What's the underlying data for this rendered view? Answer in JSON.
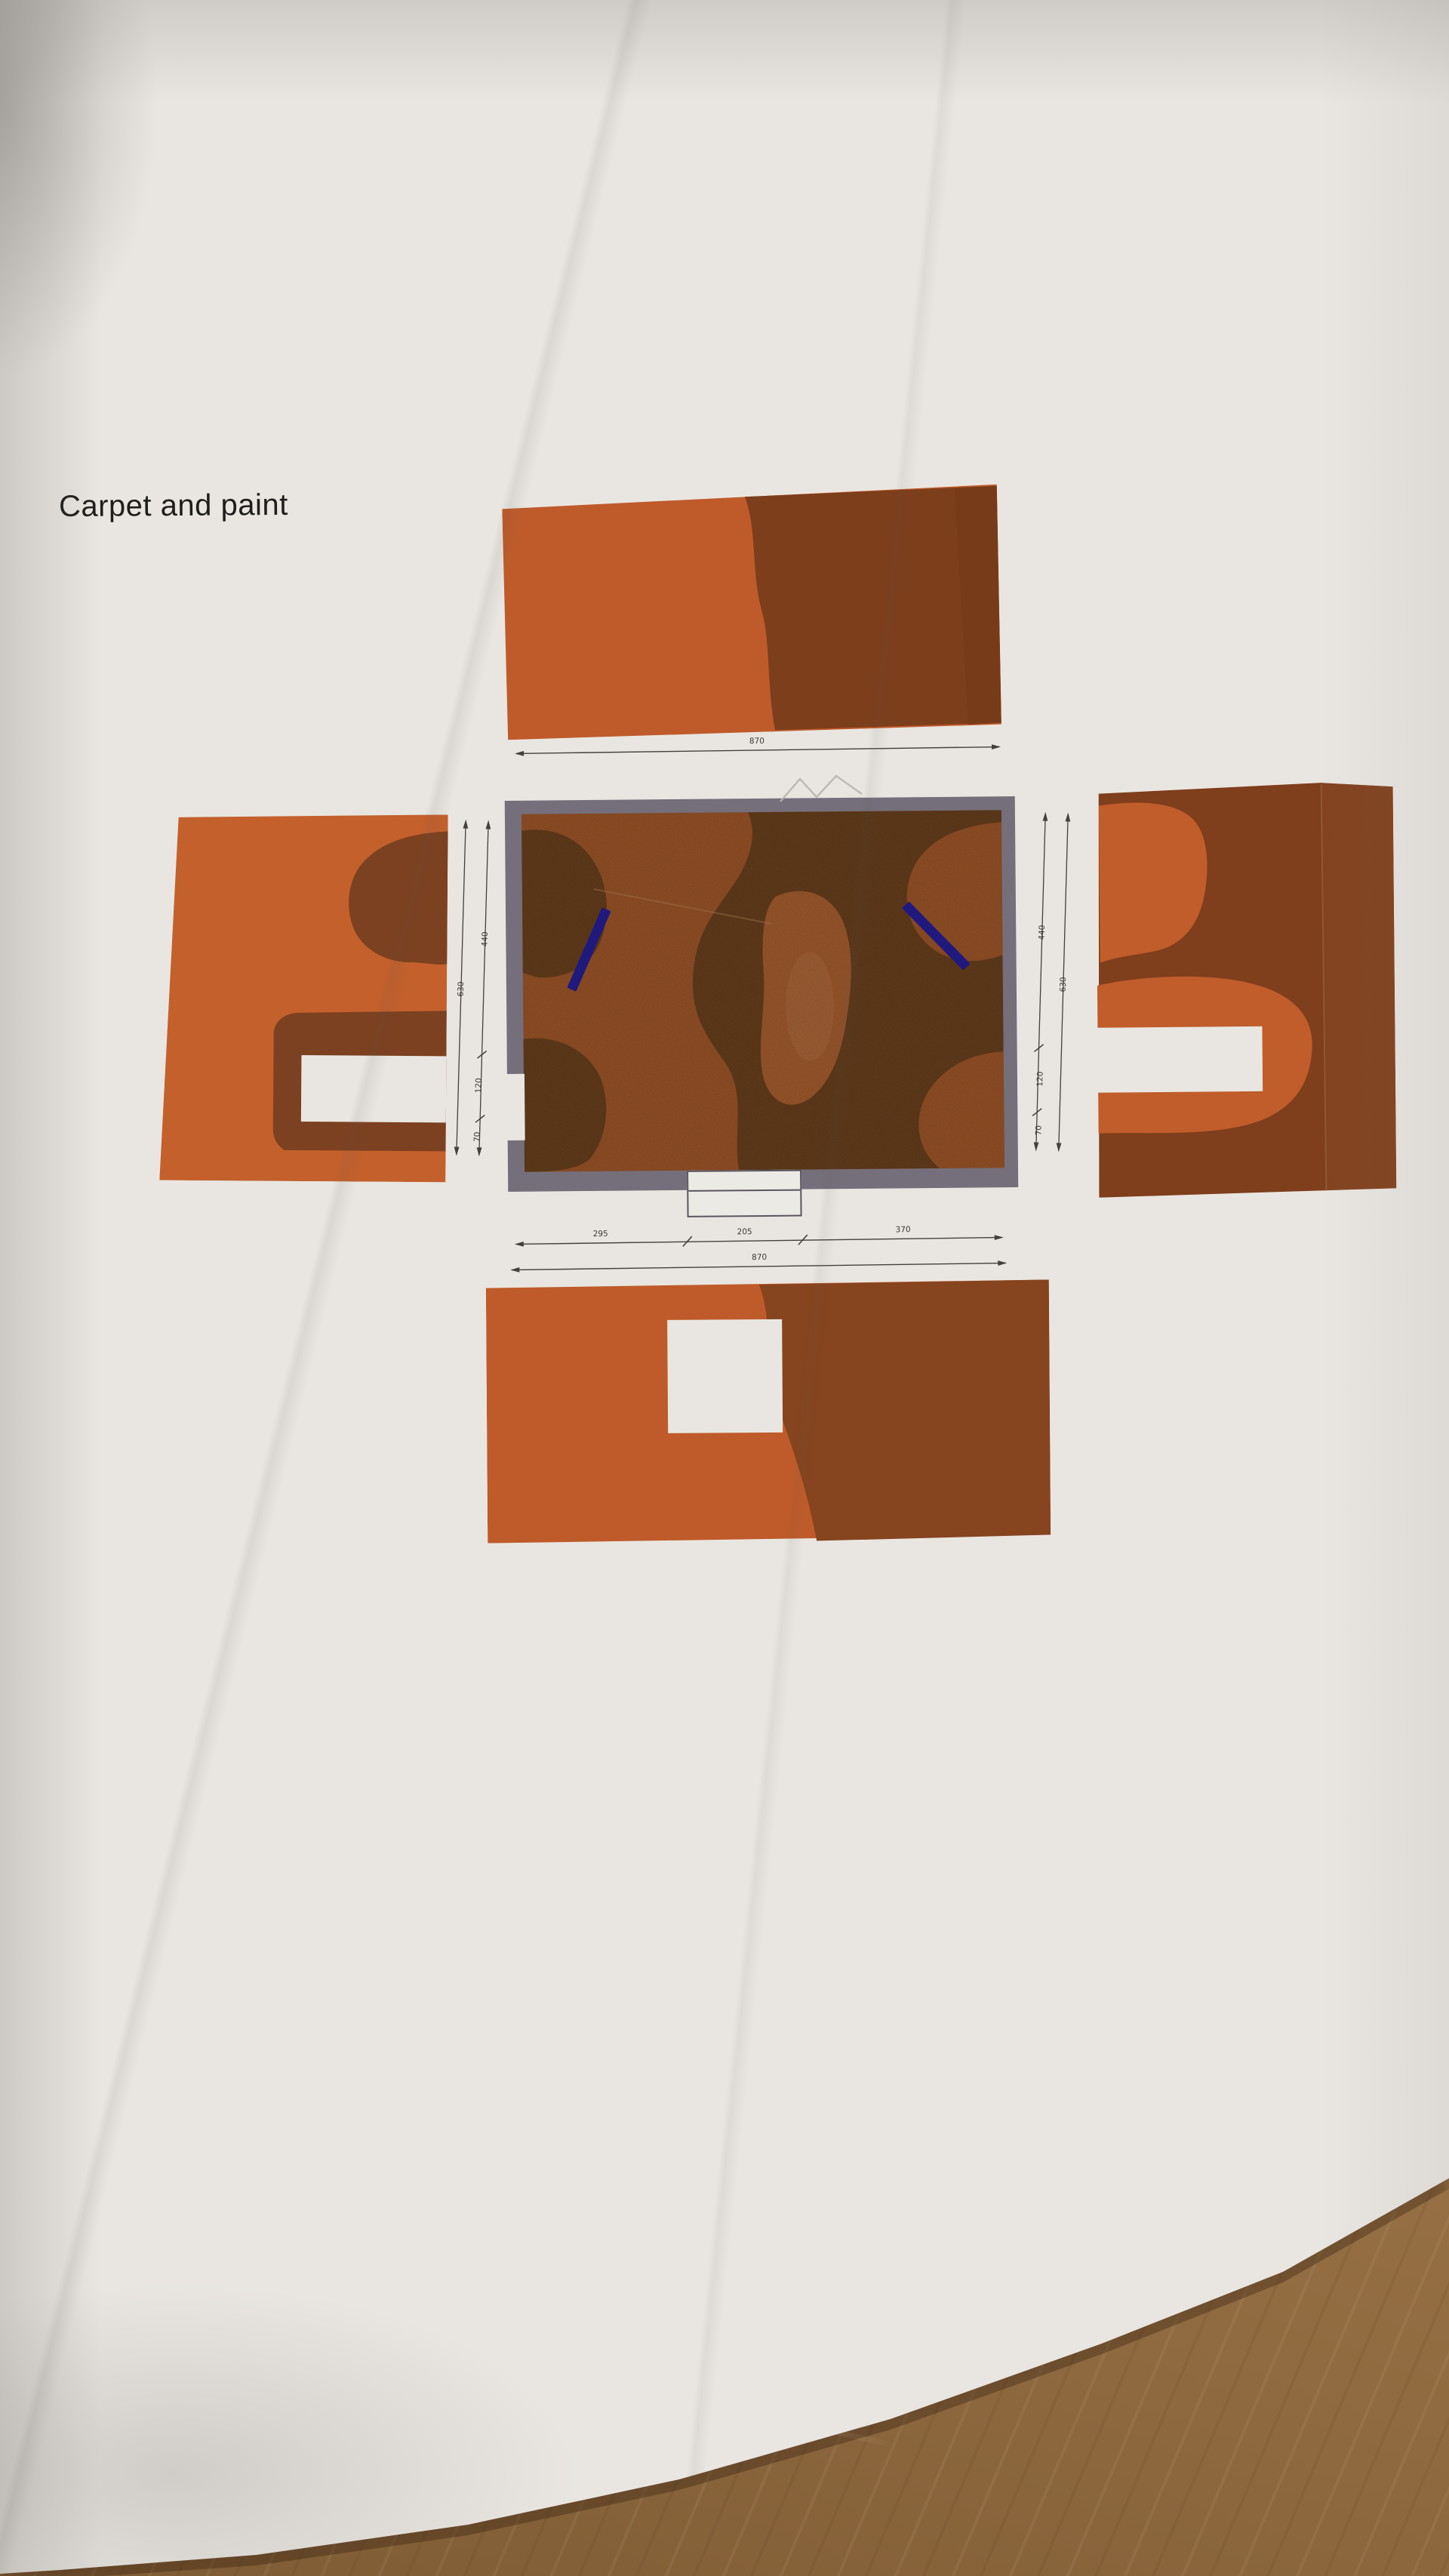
{
  "page": {
    "title": "Carpet and paint"
  },
  "dimensions": {
    "top": {
      "total": "870"
    },
    "bottom": {
      "segments": [
        "295",
        "205",
        "370"
      ],
      "total": "870"
    },
    "left": {
      "segments": [
        "440",
        "120",
        "70"
      ],
      "total": "630"
    },
    "right": {
      "segments": [
        "440",
        "120",
        "70"
      ],
      "total": "630"
    }
  },
  "colors": {
    "paint_orange": "#bf5b2a",
    "paint_rust": "#7f3f1d",
    "carpet_orange": "#b2612e",
    "carpet_brown": "#774821",
    "wall_gray": "#756f7b",
    "marker_blue": "#2b22a8",
    "paper": "#e9e6e1",
    "wood": "#ab8152"
  }
}
